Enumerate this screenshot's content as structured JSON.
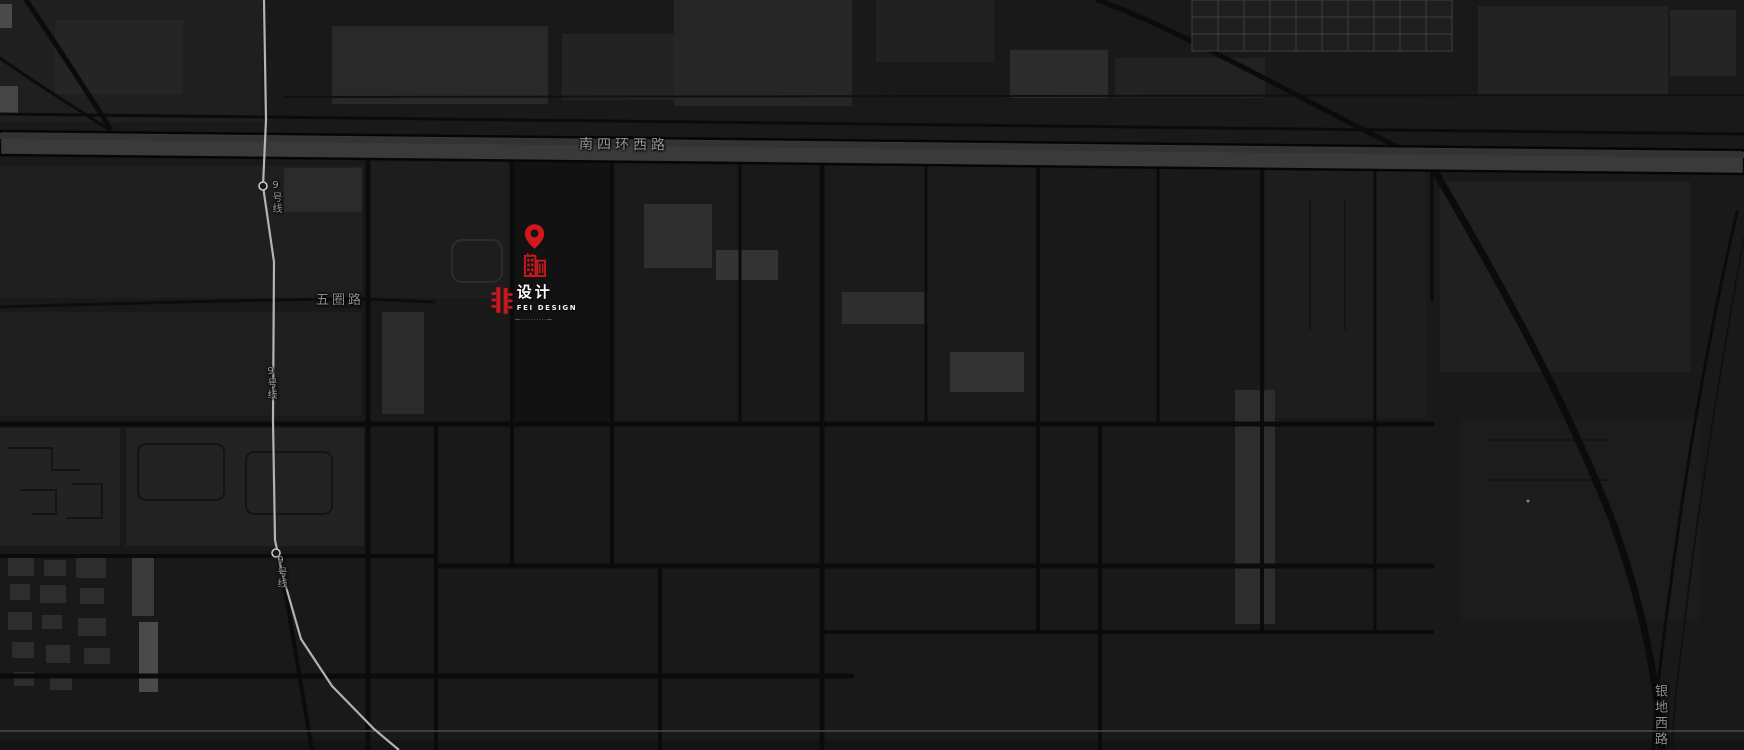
{
  "map": {
    "type": "dark-city-map",
    "background_color": "#191919",
    "accent_red": "#d3171e",
    "subway_line_color": "#b3b3b3",
    "road_label_color": "#969696",
    "labels": {
      "main_road": "南四环西路",
      "wuquan_road": "五圈路",
      "subway_line": "9号线",
      "yindi_west_road": "银地西路"
    }
  },
  "marker": {
    "pin_icon": "map-pin",
    "building_icon": "office-buildings",
    "logo": {
      "seal_character": "非",
      "brand_cn": "设计",
      "brand_en": "FEI DESIGN",
      "tagline": "—··········—"
    }
  }
}
